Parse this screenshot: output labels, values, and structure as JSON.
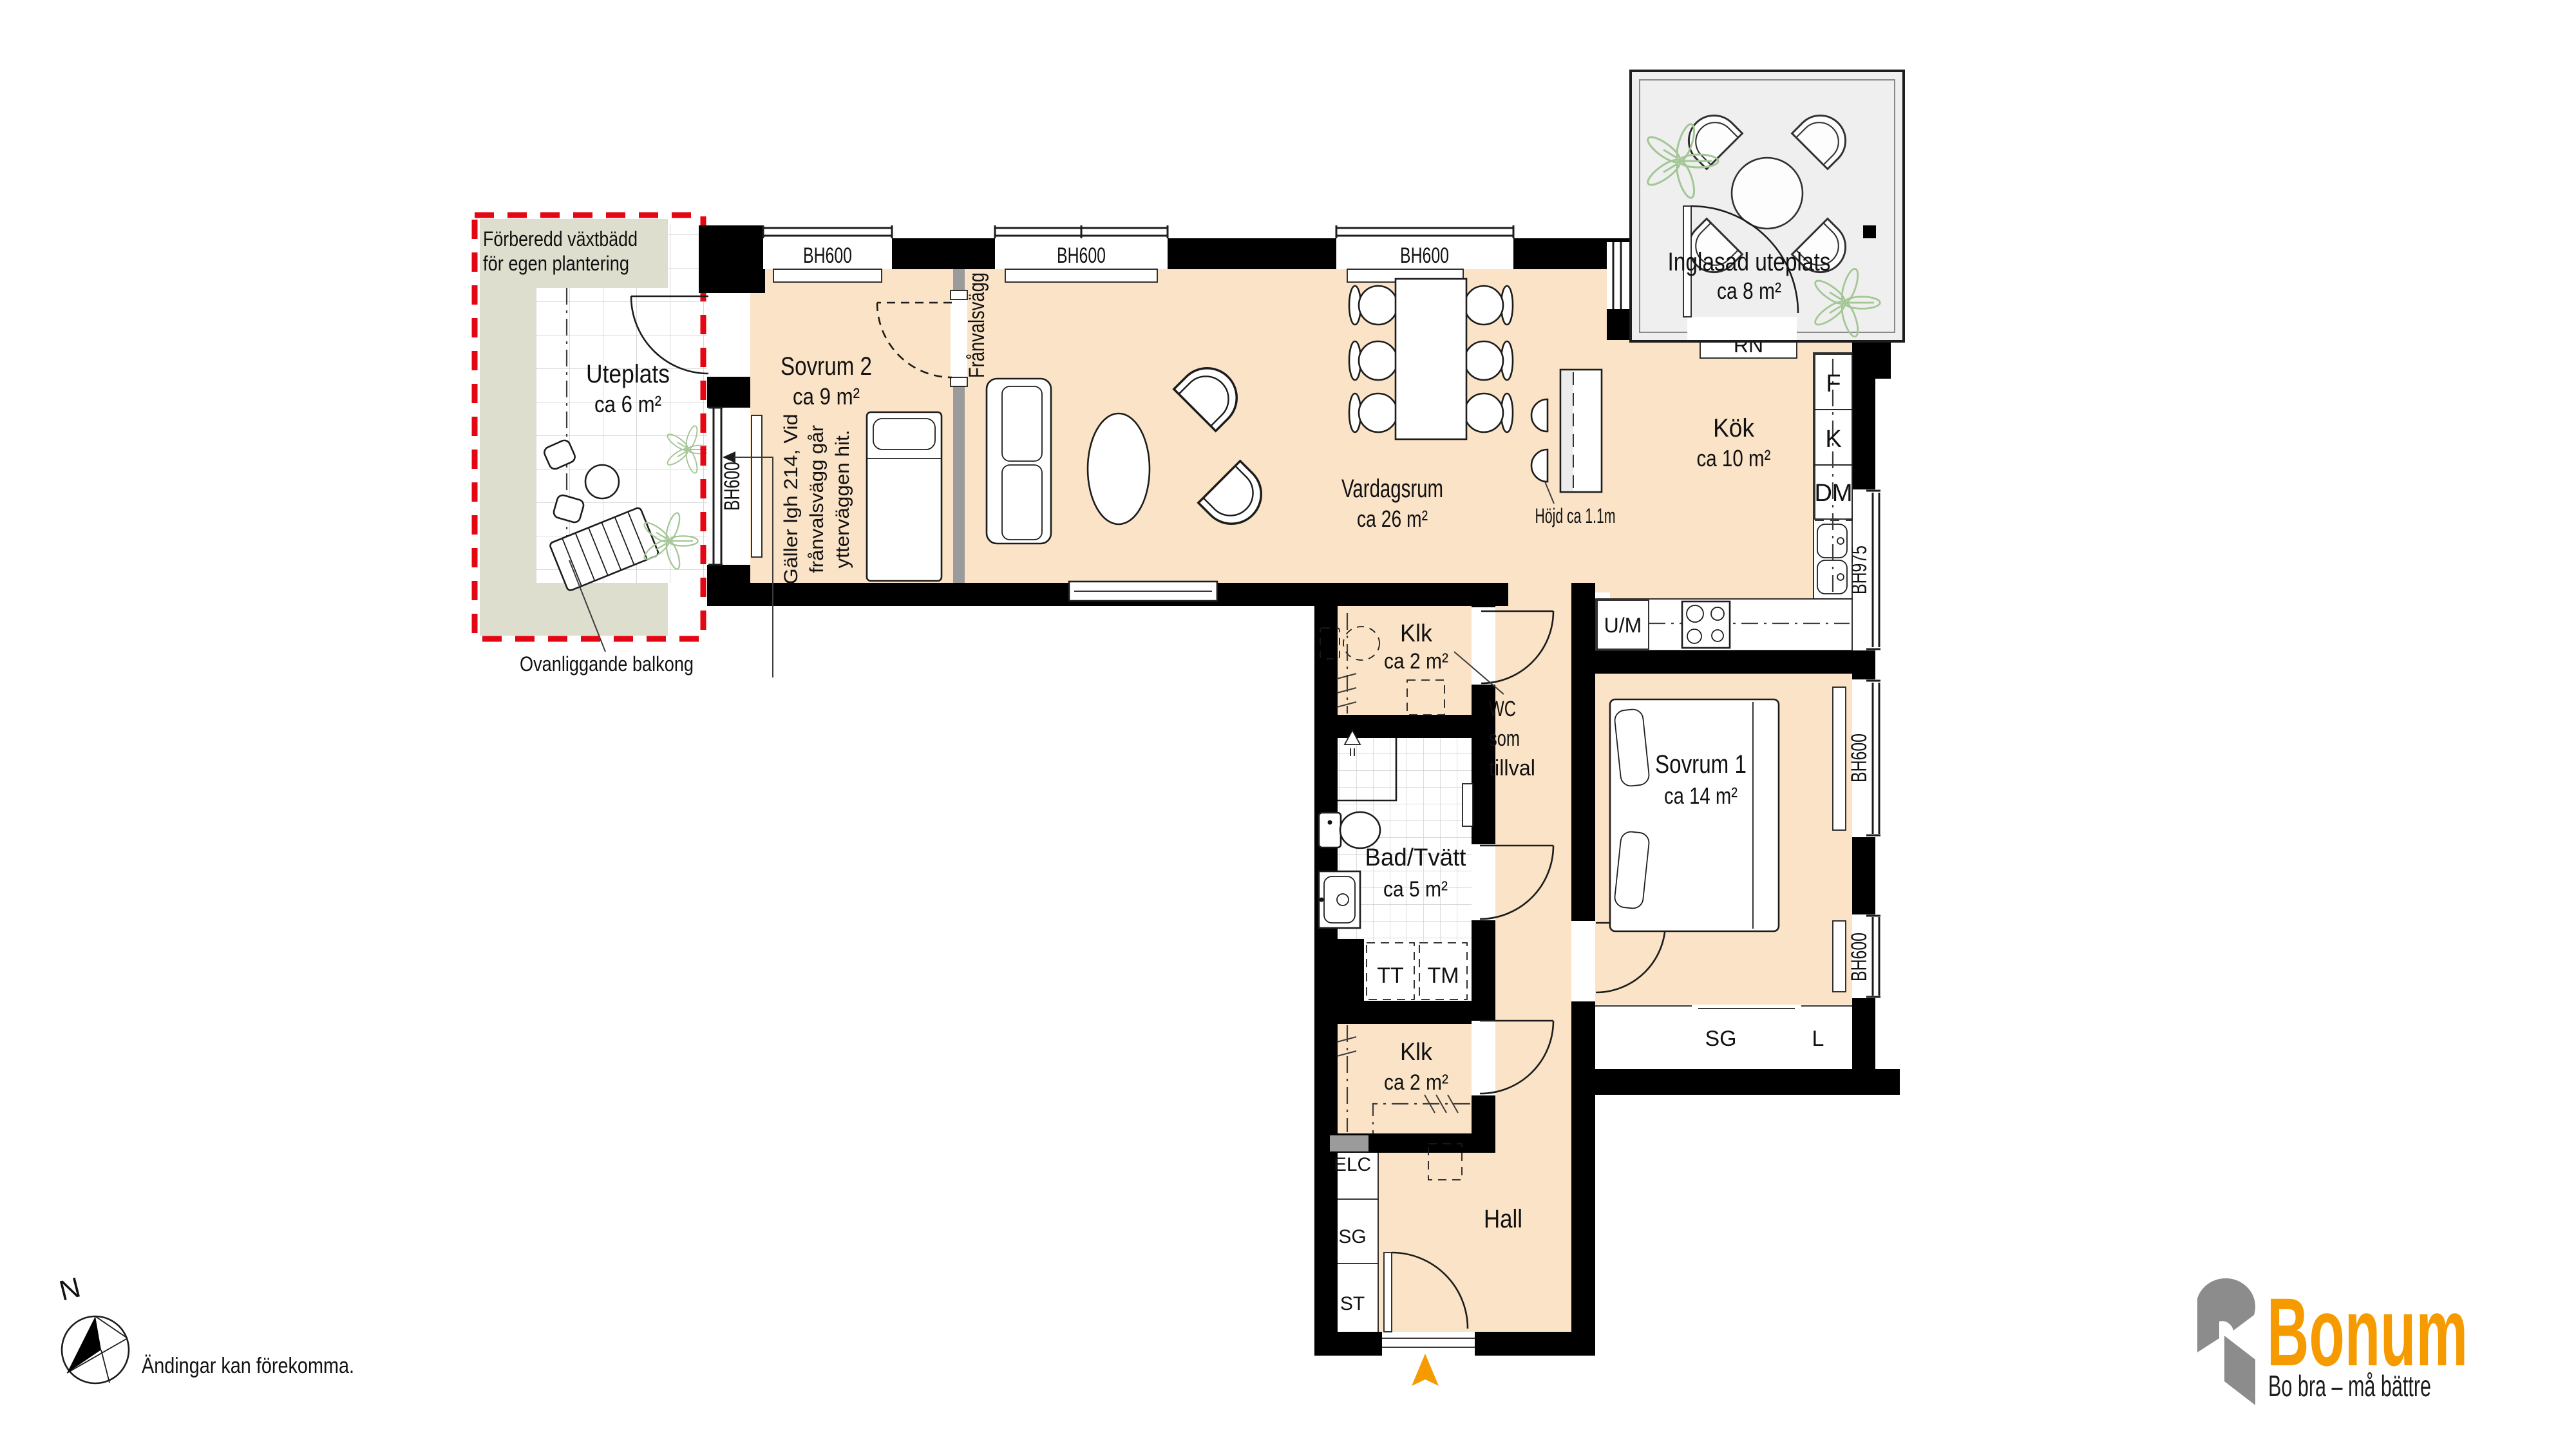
{
  "colors": {
    "floor": "#FAE3C6",
    "wall": "#000000",
    "patio_green": "#DDDECE",
    "glazed_gray": "#EFEFEF",
    "red_dashed": "#E30613",
    "arrow_orange": "#F59B00",
    "logo_orange": "#F59B00",
    "logo_gray": "#8C8C8C"
  },
  "rooms": {
    "uteplats": {
      "name": "Uteplats",
      "area": "ca 6 m²"
    },
    "sovrum2": {
      "name": "Sovrum 2",
      "area": "ca 9 m²"
    },
    "vardagsrum": {
      "name": "Vardagsrum",
      "area": "ca 26 m²"
    },
    "kok": {
      "name": "Kök",
      "area": "ca 10 m²"
    },
    "inglasad": {
      "name": "Inglasad uteplats",
      "area": "ca 8 m²"
    },
    "sovrum1": {
      "name": "Sovrum 1",
      "area": "ca 14 m²"
    },
    "badtvatt": {
      "name": "Bad/Tvätt",
      "area": "ca 5 m²"
    },
    "klk1": {
      "name": "Klk",
      "area": "ca 2 m²"
    },
    "klk2": {
      "name": "Klk",
      "area": "ca 2 m²"
    },
    "hall": {
      "name": "Hall"
    }
  },
  "windows": {
    "bh600": "BH600",
    "bh975": "BH975"
  },
  "units": {
    "f": "F",
    "k": "K",
    "dm": "DM",
    "um": "U/M",
    "rn": "RN",
    "tt": "TT",
    "tm": "TM",
    "elc": "ELC",
    "sg": "SG",
    "st": "ST",
    "l": "L"
  },
  "notes": {
    "vaxtbadd_line1": "Förberedd växtbädd",
    "vaxtbadd_line2": "för egen plantering",
    "balkong": "Ovanliggande balkong",
    "franvalsvagg": "Frånvalsvägg",
    "galler_line1": "Gäller lgh 214, Vid",
    "galler_line2": "frånvalsvägg går",
    "galler_line3": "ytterväggen hit.",
    "wc_line1": "WC",
    "wc_line2": "som",
    "wc_line3": "tillval",
    "hojd": "Höjd ca 1.1m"
  },
  "footer": {
    "disclaimer": "Ändingar kan förekomma.",
    "north": "N"
  },
  "logo": {
    "brand": "Bonum",
    "tagline": "Bo bra – må bättre"
  }
}
